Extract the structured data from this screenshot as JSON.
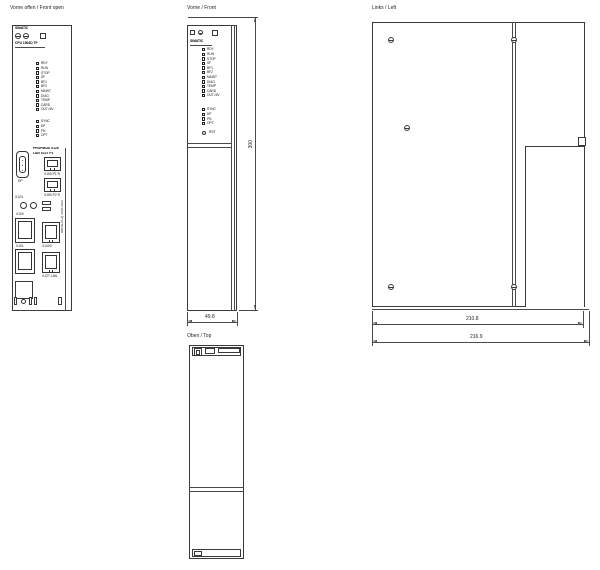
{
  "views": {
    "front_open": {
      "title": "Vorne offen / Front open",
      "header": {
        "brand": "SIMATIC",
        "model": "CPU 1504D TF"
      },
      "leds_main": [
        "RDY",
        "RUN",
        "STOP",
        "SF",
        "BF1",
        "BF2",
        "MAINT",
        "DIAG",
        "TEMP",
        "CARD",
        "OUT>5V"
      ],
      "leds_aux": [
        "SYNC",
        "DP",
        "PN",
        "OPT"
      ],
      "reset_label": "RST",
      "connectors": {
        "dsub_label1": "PROFIBUS X126",
        "dsub_label2": "LAN X127 P1",
        "dsub_sub": "DP",
        "rj45_1": "X150 P1 R",
        "rj45_2": "X150 P2 R",
        "terminals": "X124",
        "dcliq_1": "X100",
        "dcliq_2": "X101",
        "rj45_3": "X1400",
        "rj45_4": "X127 LAN",
        "side_text": "DRIVE-CLiQ X100-X102"
      }
    },
    "front": {
      "title": "Vorne / Front",
      "header_brand": "SIMATIC",
      "reset_label": "RST"
    },
    "left": {
      "title": "Links / Left"
    },
    "top": {
      "title": "Oben / Top"
    }
  },
  "dimensions": {
    "width": "49.8",
    "height": "300",
    "depth_body": "210.8",
    "depth_total": "216.9"
  },
  "colors": {
    "line": "#3a3a3a",
    "dim_text": "#1f3a93"
  }
}
